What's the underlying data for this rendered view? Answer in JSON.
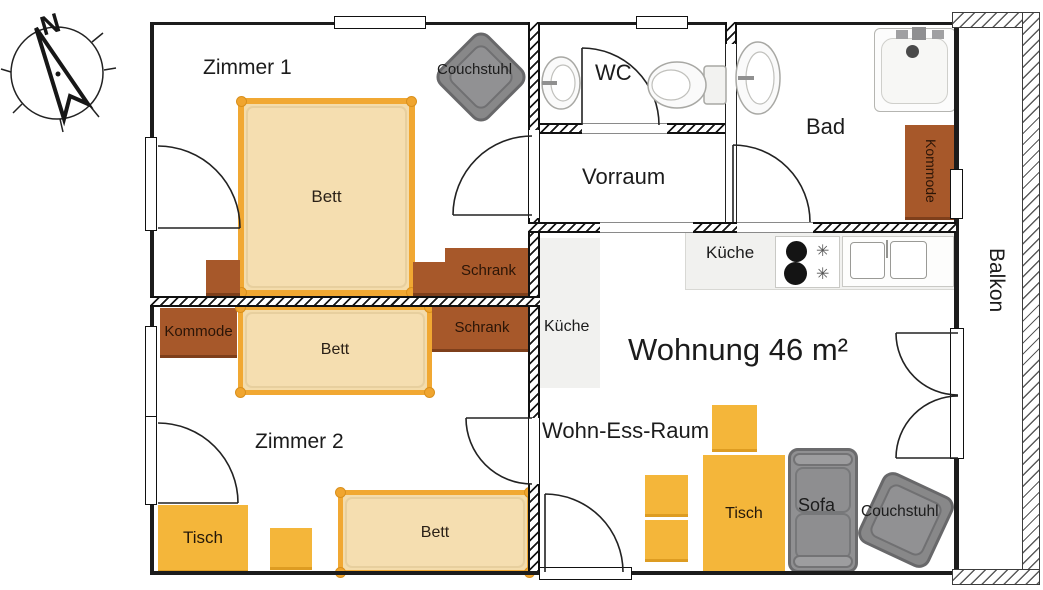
{
  "plan": {
    "compass_n": "N",
    "area_label": "Wohnung 46 m²",
    "rooms": {
      "zimmer1": "Zimmer 1",
      "zimmer2": "Zimmer 2",
      "wc": "WC",
      "bad": "Bad",
      "vorraum": "Vorraum",
      "kueche": "Küche",
      "wohn_ess_raum": "Wohn-Ess-Raum",
      "balkon": "Balkon"
    },
    "furniture": {
      "bett": "Bett",
      "schrank": "Schrank",
      "kommode": "Kommode",
      "tisch": "Tisch",
      "sofa": "Sofa",
      "couchstuhl": "Couchstuhl"
    },
    "stove_knob_glyph": "✳",
    "colors": {
      "bed_frame": "#f1a832",
      "bed_fill": "#f4dcab",
      "wood_brown": "#a7582a",
      "furniture_yellow": "#f4b63a",
      "upholstery_gray": "#8e8e90",
      "counter_gray": "#f1f1ef",
      "wall_black": "#1c1c1c"
    }
  }
}
